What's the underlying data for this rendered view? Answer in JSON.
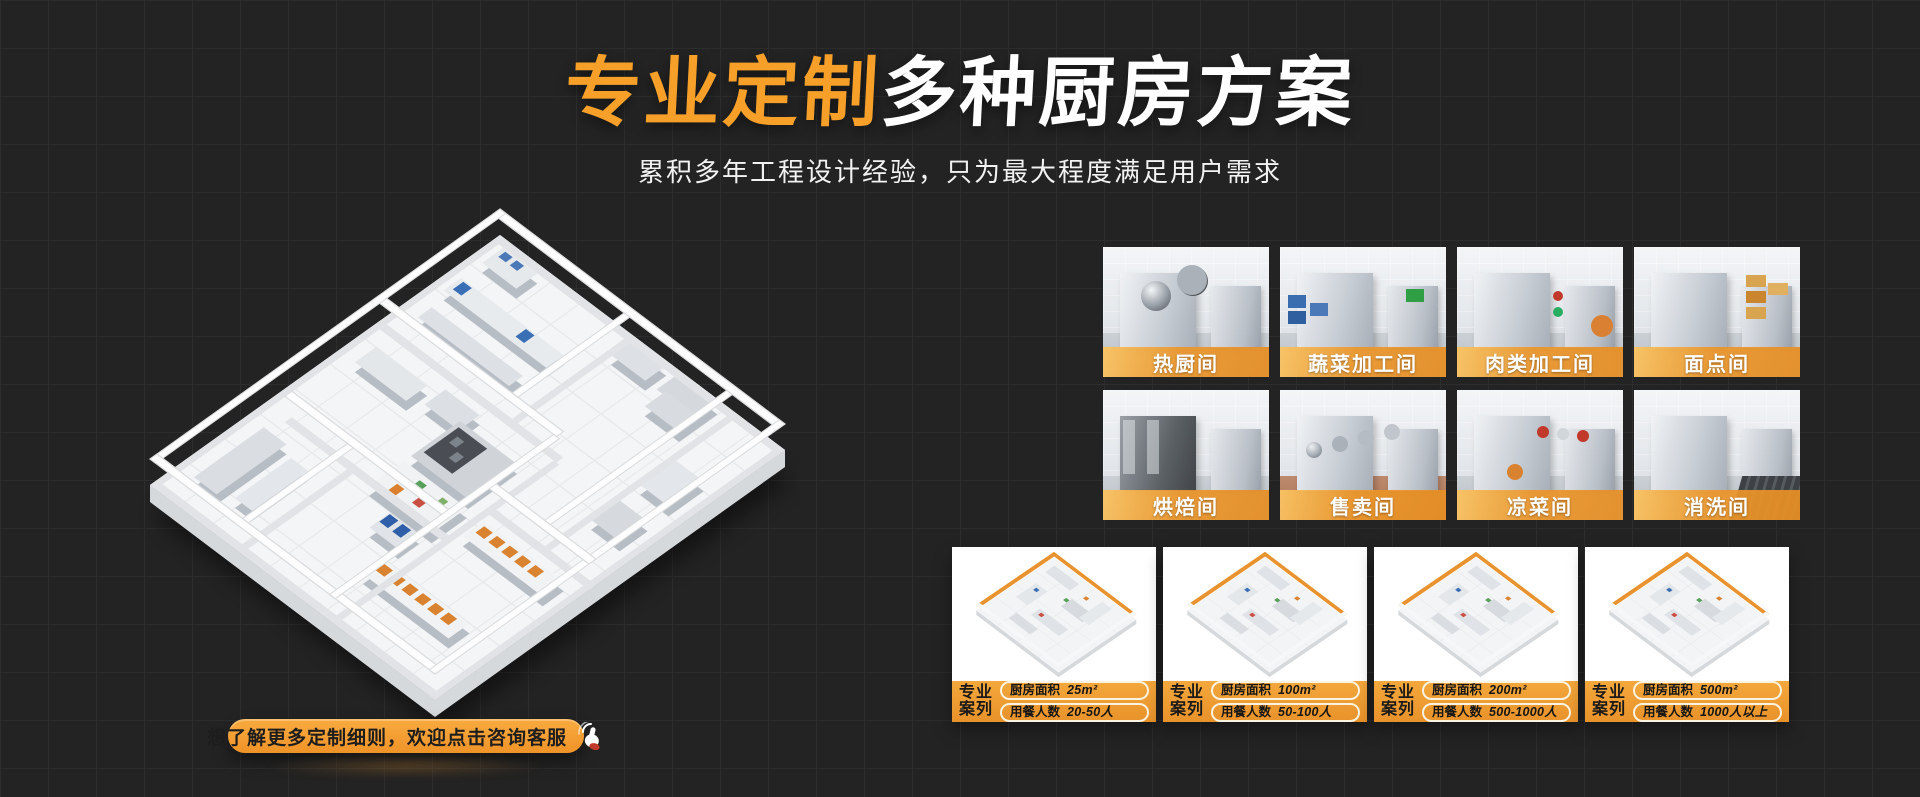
{
  "colors": {
    "background": "#232323",
    "grid_line": "#2d2d2d",
    "accent_orange": "#f6a02a"
  },
  "hero": {
    "title_accent": "专业定制",
    "title_rest": "多种厨房方案",
    "subtitle": "累积多年工程设计经验，只为最大程度满足用户需求"
  },
  "floorplan": {
    "icon": "isometric-kitchen-floorplan"
  },
  "room_cards": [
    {
      "label": "热厨间"
    },
    {
      "label": "蔬菜加工间"
    },
    {
      "label": "肉类加工间"
    },
    {
      "label": "面点间"
    },
    {
      "label": "烘焙间"
    },
    {
      "label": "售卖间"
    },
    {
      "label": "凉菜间"
    },
    {
      "label": "消洗间"
    }
  ],
  "case_cards": [
    {
      "badge_line1": "专业",
      "badge_line2": "案列",
      "area_label": "厨房面积",
      "area_value": "25m²",
      "diners_label": "用餐人数",
      "diners_value": "20-50人"
    },
    {
      "badge_line1": "专业",
      "badge_line2": "案列",
      "area_label": "厨房面积",
      "area_value": "100m²",
      "diners_label": "用餐人数",
      "diners_value": "50-100人"
    },
    {
      "badge_line1": "专业",
      "badge_line2": "案列",
      "area_label": "厨房面积",
      "area_value": "200m²",
      "diners_label": "用餐人数",
      "diners_value": "500-1000人"
    },
    {
      "badge_line1": "专业",
      "badge_line2": "案列",
      "area_label": "厨房面积",
      "area_value": "500m²",
      "diners_label": "用餐人数",
      "diners_value": "1000人以上"
    }
  ],
  "cta": {
    "label": "想了解更多定制细则，欢迎点击咨询客服",
    "icon": "click-hand-icon"
  }
}
